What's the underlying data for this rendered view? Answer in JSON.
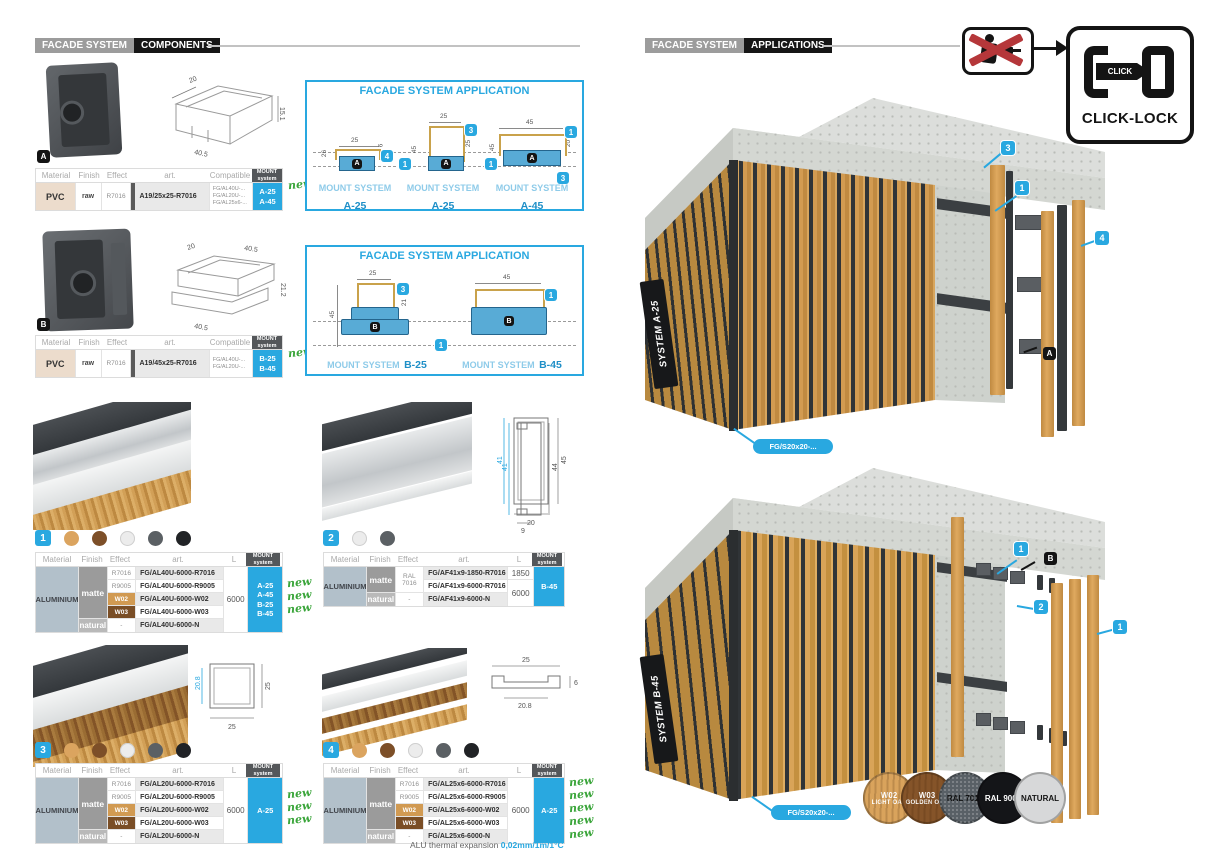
{
  "accent": "#29a8e0",
  "left": {
    "header": {
      "system": "FACADE SYSTEM",
      "section": "COMPONENTS"
    },
    "comp_headers": {
      "material": "Material",
      "finish": "Finish",
      "effect": "Effect",
      "art": "art.",
      "compatible": "Compatible",
      "mount_l1": "MOUNT",
      "mount_l2": "system"
    },
    "prof_headers": {
      "material": "Material",
      "finish": "Finish",
      "effect": "Effect",
      "art": "art.",
      "length": "L",
      "mount_l1": "MOUNT",
      "mount_l2": "system"
    },
    "comp_a": {
      "badge": "A",
      "dims": {
        "top": "20",
        "bottom": "40.5",
        "right": "15.1"
      },
      "material": "PVC",
      "finish": "raw",
      "effect": "R7016",
      "art": "A19/25x25-R7016",
      "compatible": [
        "FG/AL40U-...",
        "FG/AL20U-...",
        "FG/AL25x6-..."
      ],
      "mount": [
        "A-25",
        "A-45"
      ],
      "new_label": "new"
    },
    "app_a": {
      "title": "FACADE SYSTEM APPLICATION",
      "diagrams": [
        {
          "dim_top": "25",
          "dim_left": "26",
          "dim_right": "6",
          "co_top": "4",
          "co_bot": "1",
          "badge": "A",
          "label": "MOUNT SYSTEM",
          "system": "A-25"
        },
        {
          "dim_top": "25",
          "dim_left": "45",
          "dim_right": "25",
          "co_top": "3",
          "co_bot": "1",
          "badge": "A",
          "label": "MOUNT SYSTEM",
          "system": "A-25"
        },
        {
          "dim_top": "45",
          "dim_left": "45",
          "dim_right": "20",
          "co_top": "1",
          "co_bot": "3",
          "badge": "A",
          "label": "MOUNT SYSTEM",
          "system": "A-45"
        }
      ]
    },
    "comp_b": {
      "badge": "B",
      "dims": {
        "top_l": "20",
        "top_r": "40.5",
        "right": "21.2",
        "bottom": "40.5"
      },
      "material": "PVC",
      "finish": "raw",
      "effect": "R7016",
      "art": "A19/45x25-R7016",
      "compatible": [
        "FG/AL40U-...",
        "FG/AL20U-..."
      ],
      "mount": [
        "B-25",
        "B-45"
      ],
      "new_label": "new"
    },
    "app_b": {
      "title": "FACADE SYSTEM APPLICATION",
      "shared_co": "1",
      "diagrams": [
        {
          "dim_top": "25",
          "dim_left": "45",
          "dim_right": "21",
          "co": "3",
          "badge": "B",
          "label": "MOUNT SYSTEM",
          "system": "B-25"
        },
        {
          "dim_top": "45",
          "co": "1",
          "badge": "B",
          "label": "MOUNT SYSTEM",
          "system": "B-45"
        }
      ]
    },
    "p1": {
      "chip": "1",
      "dots": [
        "#dba45f",
        "#7d4f28",
        "#ececec",
        "#5b6064",
        "#212326"
      ],
      "dims": {
        "left": "41",
        "right": "45",
        "bottom": "20"
      },
      "material": "ALUMINIUM",
      "finish_matte": "matte",
      "finish_natural": "natural",
      "effects": [
        "R7016",
        "R9005",
        "W02",
        "W03",
        "-"
      ],
      "arts": [
        "FG/AL40U-6000-R7016",
        "FG/AL40U-6000-R9005",
        "FG/AL40U-6000-W02",
        "FG/AL40U-6000-W03",
        "FG/AL40U-6000-N"
      ],
      "length": "6000",
      "mount": [
        "A-25",
        "A-45",
        "B-25",
        "B-45"
      ],
      "news": [
        "new",
        "new",
        "new"
      ]
    },
    "p2": {
      "chip": "2",
      "dots": [
        "#ececec",
        "#5b6064"
      ],
      "dims": {
        "left": "41",
        "right": "44",
        "bottom": "9"
      },
      "material": "ALUMINIUM",
      "finish_matte": "matte",
      "finish_natural": "natural",
      "effect_matte": "RAL 7016",
      "effect_natural": "-",
      "arts": [
        "FG/AF41x9-1850-R7016",
        "FG/AF41x9-6000-R7016",
        "FG/AF41x9-6000-N"
      ],
      "lengths": [
        "1850",
        "6000"
      ],
      "mount": [
        "B-45"
      ]
    },
    "p3": {
      "chip": "3",
      "dots": [
        "#dba45f",
        "#7d4f28",
        "#ececec",
        "#5b6064",
        "#212326"
      ],
      "dims": {
        "left": "20.8",
        "right": "25",
        "bottom": "25"
      },
      "material": "ALUMINIUM",
      "finish_matte": "matte",
      "finish_natural": "natural",
      "effects": [
        "R7016",
        "R9005",
        "W02",
        "W03",
        "-"
      ],
      "arts": [
        "FG/AL20U-6000-R7016",
        "FG/AL20U-6000-R9005",
        "FG/AL20U-6000-W02",
        "FG/AL20U-6000-W03",
        "FG/AL20U-6000-N"
      ],
      "length": "6000",
      "mount": [
        "A-25"
      ],
      "news": [
        "new",
        "new",
        "new"
      ]
    },
    "p4": {
      "chip": "4",
      "dots": [
        "#dba45f",
        "#7d4f28",
        "#ececec",
        "#5b6064",
        "#212326"
      ],
      "dims": {
        "top": "25",
        "bottom": "20.8",
        "right": "6"
      },
      "material": "ALUMINIUM",
      "finish_matte": "matte",
      "finish_natural": "natural",
      "effects": [
        "R7016",
        "R9005",
        "W02",
        "W03",
        "-"
      ],
      "arts": [
        "FG/AL25x6-6000-R7016",
        "FG/AL25x6-6000-R9005",
        "FG/AL25x6-6000-W02",
        "FG/AL25x6-6000-W03",
        "FG/AL25x6-6000-N"
      ],
      "length": "6000",
      "mount": [
        "A-25"
      ],
      "news": [
        "new",
        "new",
        "new",
        "new",
        "new"
      ]
    },
    "note": {
      "label": "ALU thermal expansion ",
      "value": "0,02mm/1m/1°C"
    }
  },
  "right": {
    "header": {
      "system": "FACADE SYSTEM",
      "section": "APPLICATIONS"
    },
    "clicklock": {
      "click": "CLICK",
      "label": "CLICK-LOCK"
    },
    "sys_a": {
      "plaque": "SYSTEM A-25",
      "part": "FG/S20x20-...",
      "co3": "3",
      "co1": "1",
      "co4": "4",
      "badge": "A"
    },
    "sys_b": {
      "plaque": "SYSTEM B-45",
      "part": "FG/S20x20-...",
      "co1a": "1",
      "badge": "B",
      "co2": "2",
      "co1b": "1"
    },
    "swatches": [
      {
        "code": "W02",
        "name": "LIGHT OAK",
        "color": "#d9a35c",
        "text": "#ffffff"
      },
      {
        "code": "W03",
        "name": "GOLDEN OAK",
        "color": "#855429",
        "text": "#ffffff"
      },
      {
        "code": "RAL 7016",
        "name": "",
        "color": "#596066",
        "text": "#1a1a1a"
      },
      {
        "code": "RAL 9005",
        "name": "",
        "color": "#141518",
        "text": "#ffffff"
      },
      {
        "code": "NATURAL",
        "name": "",
        "color": "#d7d8d9",
        "text": "#1a1a1a"
      }
    ]
  }
}
